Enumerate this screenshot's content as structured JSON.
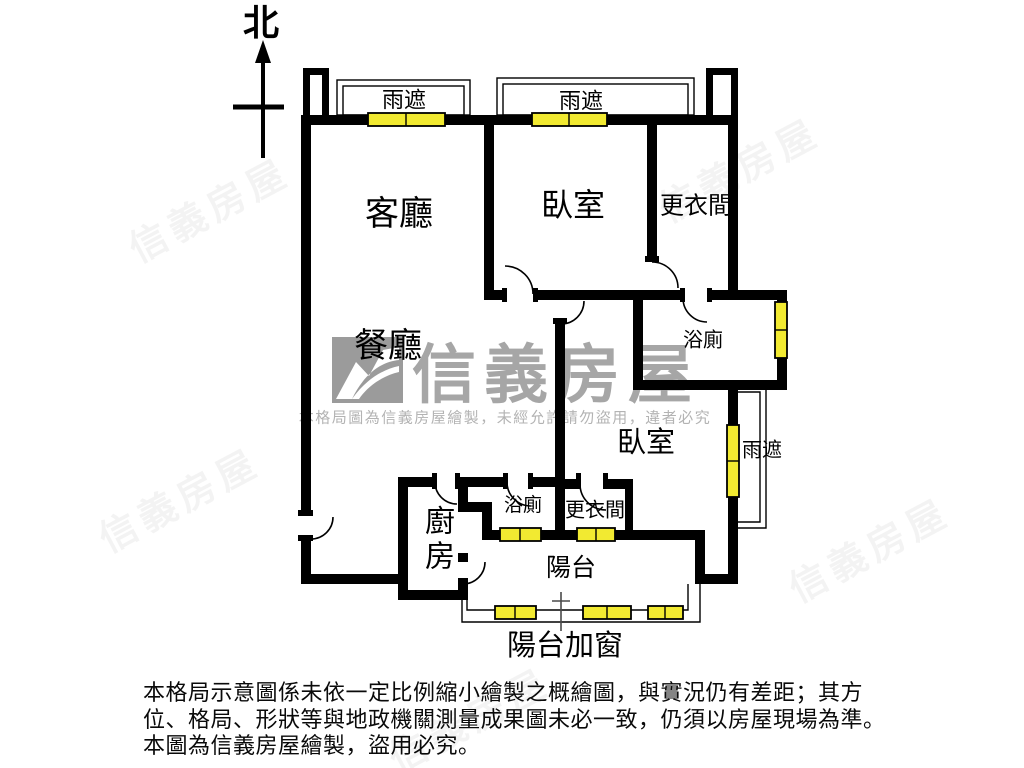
{
  "north_label": "北",
  "rooms": [
    {
      "name": "living-room",
      "label": "客廳"
    },
    {
      "name": "bedroom-1",
      "label": "臥室"
    },
    {
      "name": "closet-1",
      "label": "更衣間"
    },
    {
      "name": "bathroom-1",
      "label": "浴廁"
    },
    {
      "name": "dining-room",
      "label": "餐廳"
    },
    {
      "name": "bedroom-2",
      "label": "臥室"
    },
    {
      "name": "kitchen",
      "label": "廚房"
    },
    {
      "name": "bathroom-2",
      "label": "浴廁"
    },
    {
      "name": "closet-2",
      "label": "更衣間"
    },
    {
      "name": "balcony",
      "label": "陽台"
    }
  ],
  "annotations": {
    "rain_shelter_top_left": "雨遮",
    "rain_shelter_top_right": "雨遮",
    "rain_shelter_right": "雨遮",
    "balcony_added_window": "陽台加窗"
  },
  "watermark": {
    "brand": "信義房屋",
    "notice": "本格局圖為信義房屋繪製，未經允許請勿盜用，違者必究"
  },
  "disclaimer": {
    "line1": "本格局示意圖係未依一定比例縮小繪製之概繪圖，與實況仍有差距；其方",
    "line2": "位、格局、形狀等與地政機關測量成果圖未必一致，仍須以房屋現場為準。",
    "line3": "本圖為信義房屋繪製，盜用必究。"
  },
  "colors": {
    "wall": "#000000",
    "window_fill": "#f2ea31",
    "watermark_gray": "#a6a6a6"
  }
}
